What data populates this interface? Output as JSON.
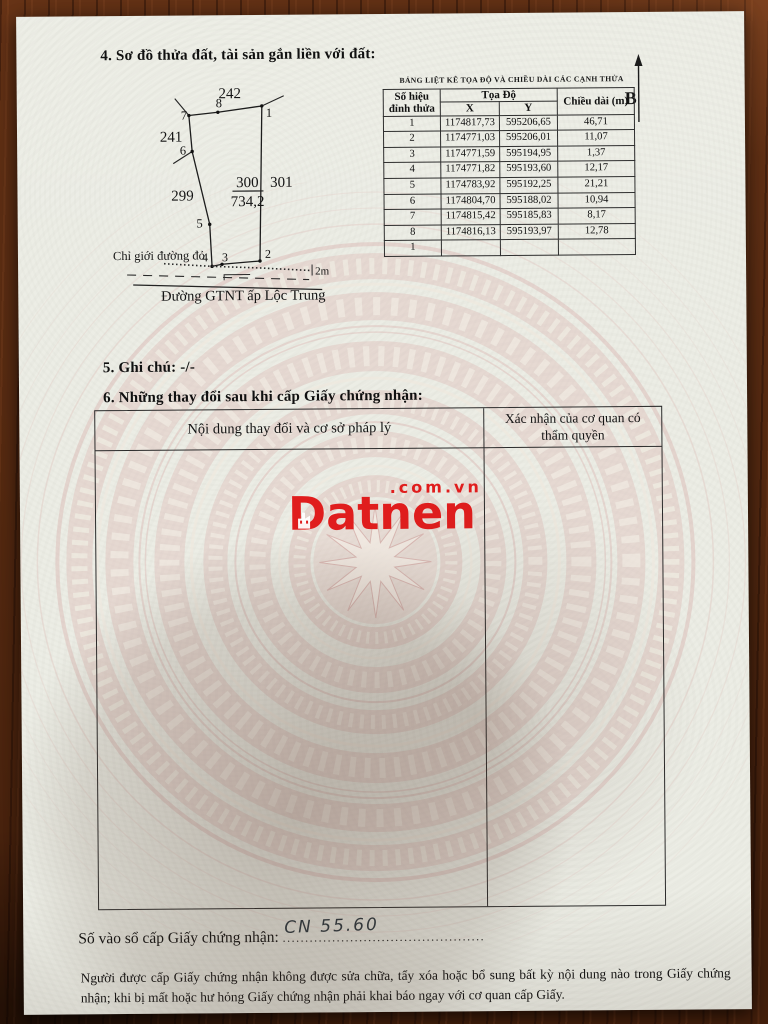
{
  "sections": {
    "s4": "4. Sơ đồ thửa đất, tài sản gắn liền với đất:",
    "s5": "5. Ghi chú: -/-",
    "s6": "6. Những thay đổi sau khi cấp Giấy chứng nhận:"
  },
  "diagram": {
    "north": "B",
    "labels": {
      "adj_top": "242",
      "adj_left": "241",
      "adj_left_lower": "299",
      "adj_right": "301",
      "plot_number": "300",
      "plot_area": "734,2",
      "red_line": "Chỉ giới đường đỏ",
      "road_width": "2m",
      "road_name": "Đường GTNT ấp Lộc Trung"
    },
    "vertex_labels": {
      "v1": "1",
      "v2": "2",
      "v3": "3",
      "v4": "4",
      "v5": "5",
      "v6": "6",
      "v7": "7",
      "v8": "8"
    }
  },
  "coord_table": {
    "title": "BẢNG LIỆT KÊ TỌA ĐỘ VÀ CHIỀU DÀI CÁC CẠNH THỬA",
    "header": {
      "vertex": "Số hiệu đỉnh thửa",
      "coords_group": "Tọa Độ",
      "x": "X",
      "y": "Y",
      "length": "Chiều dài (m)"
    },
    "rows": [
      {
        "id": "1",
        "x": "1174817,73",
        "y": "595206,65",
        "len": "46,71"
      },
      {
        "id": "2",
        "x": "1174771,03",
        "y": "595206,01",
        "len": "11,07"
      },
      {
        "id": "3",
        "x": "1174771,59",
        "y": "595194,95",
        "len": "1,37"
      },
      {
        "id": "4",
        "x": "1174771,82",
        "y": "595193,60",
        "len": "12,17"
      },
      {
        "id": "5",
        "x": "1174783,92",
        "y": "595192,25",
        "len": "21,21"
      },
      {
        "id": "6",
        "x": "1174804,70",
        "y": "595188,02",
        "len": "10,94"
      },
      {
        "id": "7",
        "x": "1174815,42",
        "y": "595185,83",
        "len": "8,17"
      },
      {
        "id": "8",
        "x": "1174816,13",
        "y": "595193,97",
        "len": "12,78"
      },
      {
        "id": "1",
        "x": "",
        "y": "",
        "len": ""
      }
    ]
  },
  "changes_table": {
    "col1": "Nội dung thay đổi và cơ sở pháp lý",
    "col2": "Xác nhận của cơ quan có thẩm quyền"
  },
  "watermark": {
    "brand": "Datnen",
    "suffix": ".com.vn",
    "brand_color": "#e01d1d"
  },
  "registry": {
    "label": "Số vào sổ cấp Giấy chứng nhận:",
    "value": "CN 55.60",
    "dots": "............................................."
  },
  "footer": {
    "text": "Người được cấp Giấy chứng nhận không được sửa chữa, tẩy xóa hoặc bổ sung bất kỳ nội dung nào trong Giấy chứng nhận; khi bị mất hoặc hư hỏng Giấy chứng nhận phải khai báo ngay với cơ quan cấp Giấy."
  },
  "colors": {
    "paper": "#ecede5",
    "wood": "#5a2c12",
    "drum_pink": "#dcb9b5",
    "brand_red": "#e01d1d"
  }
}
